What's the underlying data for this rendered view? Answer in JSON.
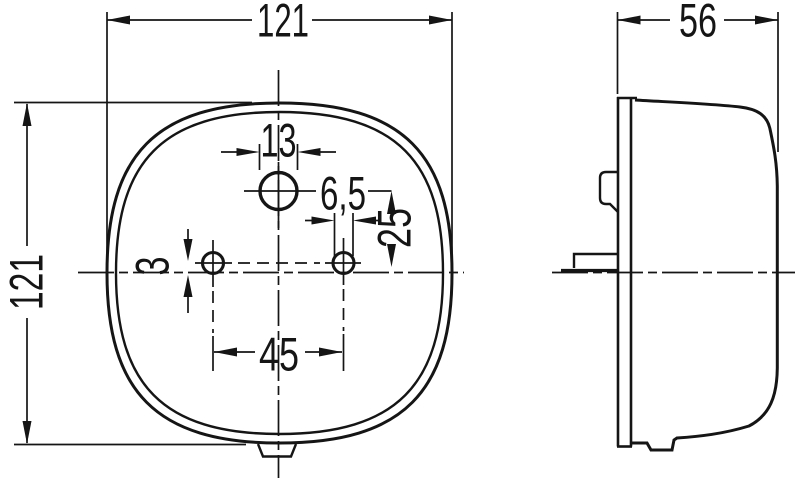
{
  "drawing": {
    "background": "#ffffff",
    "line_color": "#151515",
    "front_view": {
      "width": "121",
      "height": "121",
      "center_hole_diameter": "13",
      "mounting_hole_diameter": "6,5",
      "vertical_hole_offset": "25",
      "centerline_offset": "3",
      "mounting_hole_spacing": "45"
    },
    "side_view": {
      "depth": "56"
    }
  }
}
